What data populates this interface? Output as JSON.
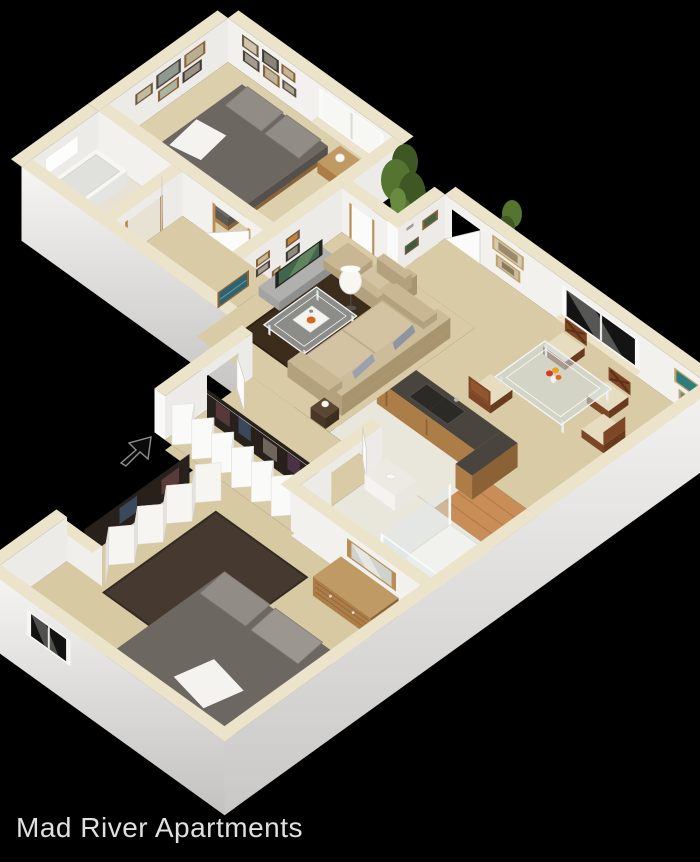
{
  "title": {
    "text": "Mad River Apartments"
  },
  "canvas": {
    "background": "#000000",
    "width": 700,
    "height": 862
  },
  "floorplan": {
    "type": "3d-isometric-apartment-floor-plan",
    "rooms": [
      "bedroom-1",
      "bathroom-1",
      "hallway",
      "courtyard",
      "living-room",
      "dining-room",
      "kitchen",
      "entry-corridor",
      "walk-in-closets",
      "master-bathroom",
      "master-bedroom"
    ],
    "furniture": [
      "bed",
      "nightstand",
      "table-lamp",
      "bathtub",
      "toilet",
      "tv-console",
      "tv",
      "armchair",
      "ottoman",
      "floor-lamp",
      "coffee-table",
      "sofa",
      "side-table",
      "dining-table",
      "dining-chairs",
      "flower-centerpiece",
      "kitchen-counter",
      "sink",
      "breakfast-bar",
      "bifold-closets",
      "vanity",
      "shower",
      "dresser",
      "mirror",
      "area-rugs",
      "framed-pictures",
      "windows",
      "entry-arrow",
      "trees"
    ],
    "colors": {
      "cap": "#ebe4cb",
      "wallIn": "#f3f1ed",
      "wallInE": "#edebe7",
      "wallShade": "#e2e0db",
      "extTop": "#f6f5f4",
      "extBot": "#c3c2c0",
      "carpet": "#d9cba5",
      "carpetBed": "#dccfab",
      "carpetM": "#d7c9a2",
      "bathFloor": "#e7e2d3",
      "tileW": "#e9e6dc",
      "tileO": "#c98d58",
      "tileOLine": "#b57c49",
      "rugL": "#3c2c1c",
      "rugM": "#453930",
      "bedTop": "#6d6761",
      "bedSide": "#5d5852",
      "pillow": "#918c86",
      "sheet": "#f4f3f0",
      "woodM": "#ad7d48",
      "woodD": "#8a6236",
      "woodTop": "#c09a64",
      "console": "#a3a3a1",
      "tv": "#262421",
      "tvScreen": "#41664b",
      "sofa": "#c9b794",
      "sofaCushion": "#d3c3a2",
      "sofaShade": "#b3a07c",
      "chairW": "#7c4627",
      "seat": "#e6dcc0",
      "counterTop": "#4a443e",
      "sink": "#2c2a27",
      "glass": "rgba(205,220,226,0.55)",
      "shower": "rgba(222,232,235,0.45)",
      "lamp": "#f7f6f1",
      "tree": "#55742f",
      "treeDark": "#3f5722",
      "treeLight": "#6a8a3f",
      "clothes": "#28211b",
      "white": "#fbfbfa",
      "trim": "#b98e55",
      "arrow": "#0b0b0b",
      "caption": "#e0e0e0"
    }
  }
}
